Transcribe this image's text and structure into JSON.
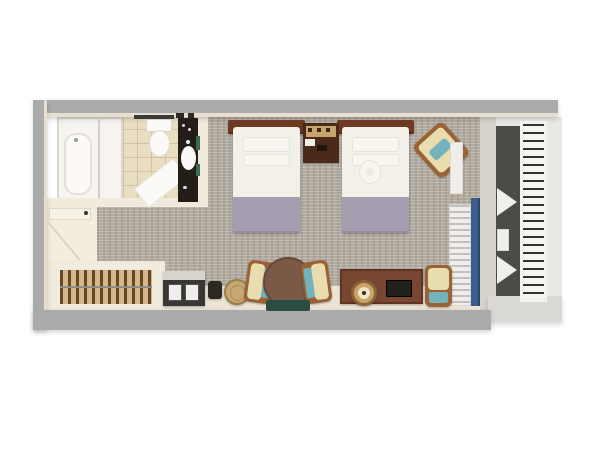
{
  "palette": {
    "wall_gray": "#ababab",
    "wall_cream": "#f1ebdd",
    "ledge_cream": "#ece5d6",
    "entry_floor": "#f3edde",
    "carpet_base": "#b2aba0",
    "tile_floor": "#e9ddc2",
    "shower_white": "#f6f4ef",
    "fixture_white": "#fbfaf6",
    "vanity_dark": "#241e18",
    "towel_green": "#3c6b52",
    "bed_white": "#f3f0e9",
    "pillow_white": "#f8f6f0",
    "bed_accent_lavender": "#a59db0",
    "headboard_brown": "#6e3a21",
    "nightstand_brown": "#4a2b1b",
    "shelf_tan": "#c8a56a",
    "wood_frame": "#9a6335",
    "cushion_cream": "#e9dcae",
    "teal_accent": "#74b3bd",
    "table_brown": "#7b5947",
    "desk_brown": "#794731",
    "mat_green": "#2a4c42",
    "lamp_tan": "#caa36a",
    "lamp_center": "#f2e7c8",
    "tv_dark": "#23211e",
    "minibar_dark": "#393734",
    "minibar_top": "#d7d4ce",
    "panel_white": "#efeeea",
    "basket_tan": "#c7a873",
    "window_wall": "#d6d3cc",
    "curtain_blue": "#3b5c8c",
    "balcony_floor": "#4b4b47",
    "balcony_white": "#e9e8e4",
    "balcony_wall_bottom": "#dad9d5",
    "door_panel": "#f7f2e6",
    "rod_gray": "#8c8c88",
    "swing_line": "#ddd4c0",
    "towel_bar_dark": "#3a3a38",
    "dark_item": "#2c2824",
    "white_tri": "#f0efeb"
  },
  "plan": {
    "rooms": [
      {
        "name": "bathroom",
        "items": [
          "shower-enclosure",
          "bathtub",
          "shower-glass",
          "toilet",
          "towel-bar",
          "bath-mat",
          "vanity",
          "sink",
          "towels"
        ]
      },
      {
        "name": "entry",
        "items": [
          "entry-door",
          "door-swing"
        ]
      },
      {
        "name": "closet",
        "items": [
          "hanger-rod",
          "hangers"
        ]
      },
      {
        "name": "bedroom",
        "items": [
          "twin-bed-1",
          "twin-bed-2",
          "nightstand",
          "corner-armchair",
          "wall-shelf",
          "radiator",
          "curtain",
          "minibar",
          "kettle",
          "basket",
          "round-table",
          "side-chair-left",
          "side-chair-right",
          "floor-mat",
          "desk-console",
          "table-lamp",
          "tv",
          "desk-chair"
        ]
      },
      {
        "name": "balcony",
        "items": [
          "louver-screen",
          "folding-chair-1",
          "side-table",
          "folding-chair-2"
        ]
      }
    ]
  }
}
